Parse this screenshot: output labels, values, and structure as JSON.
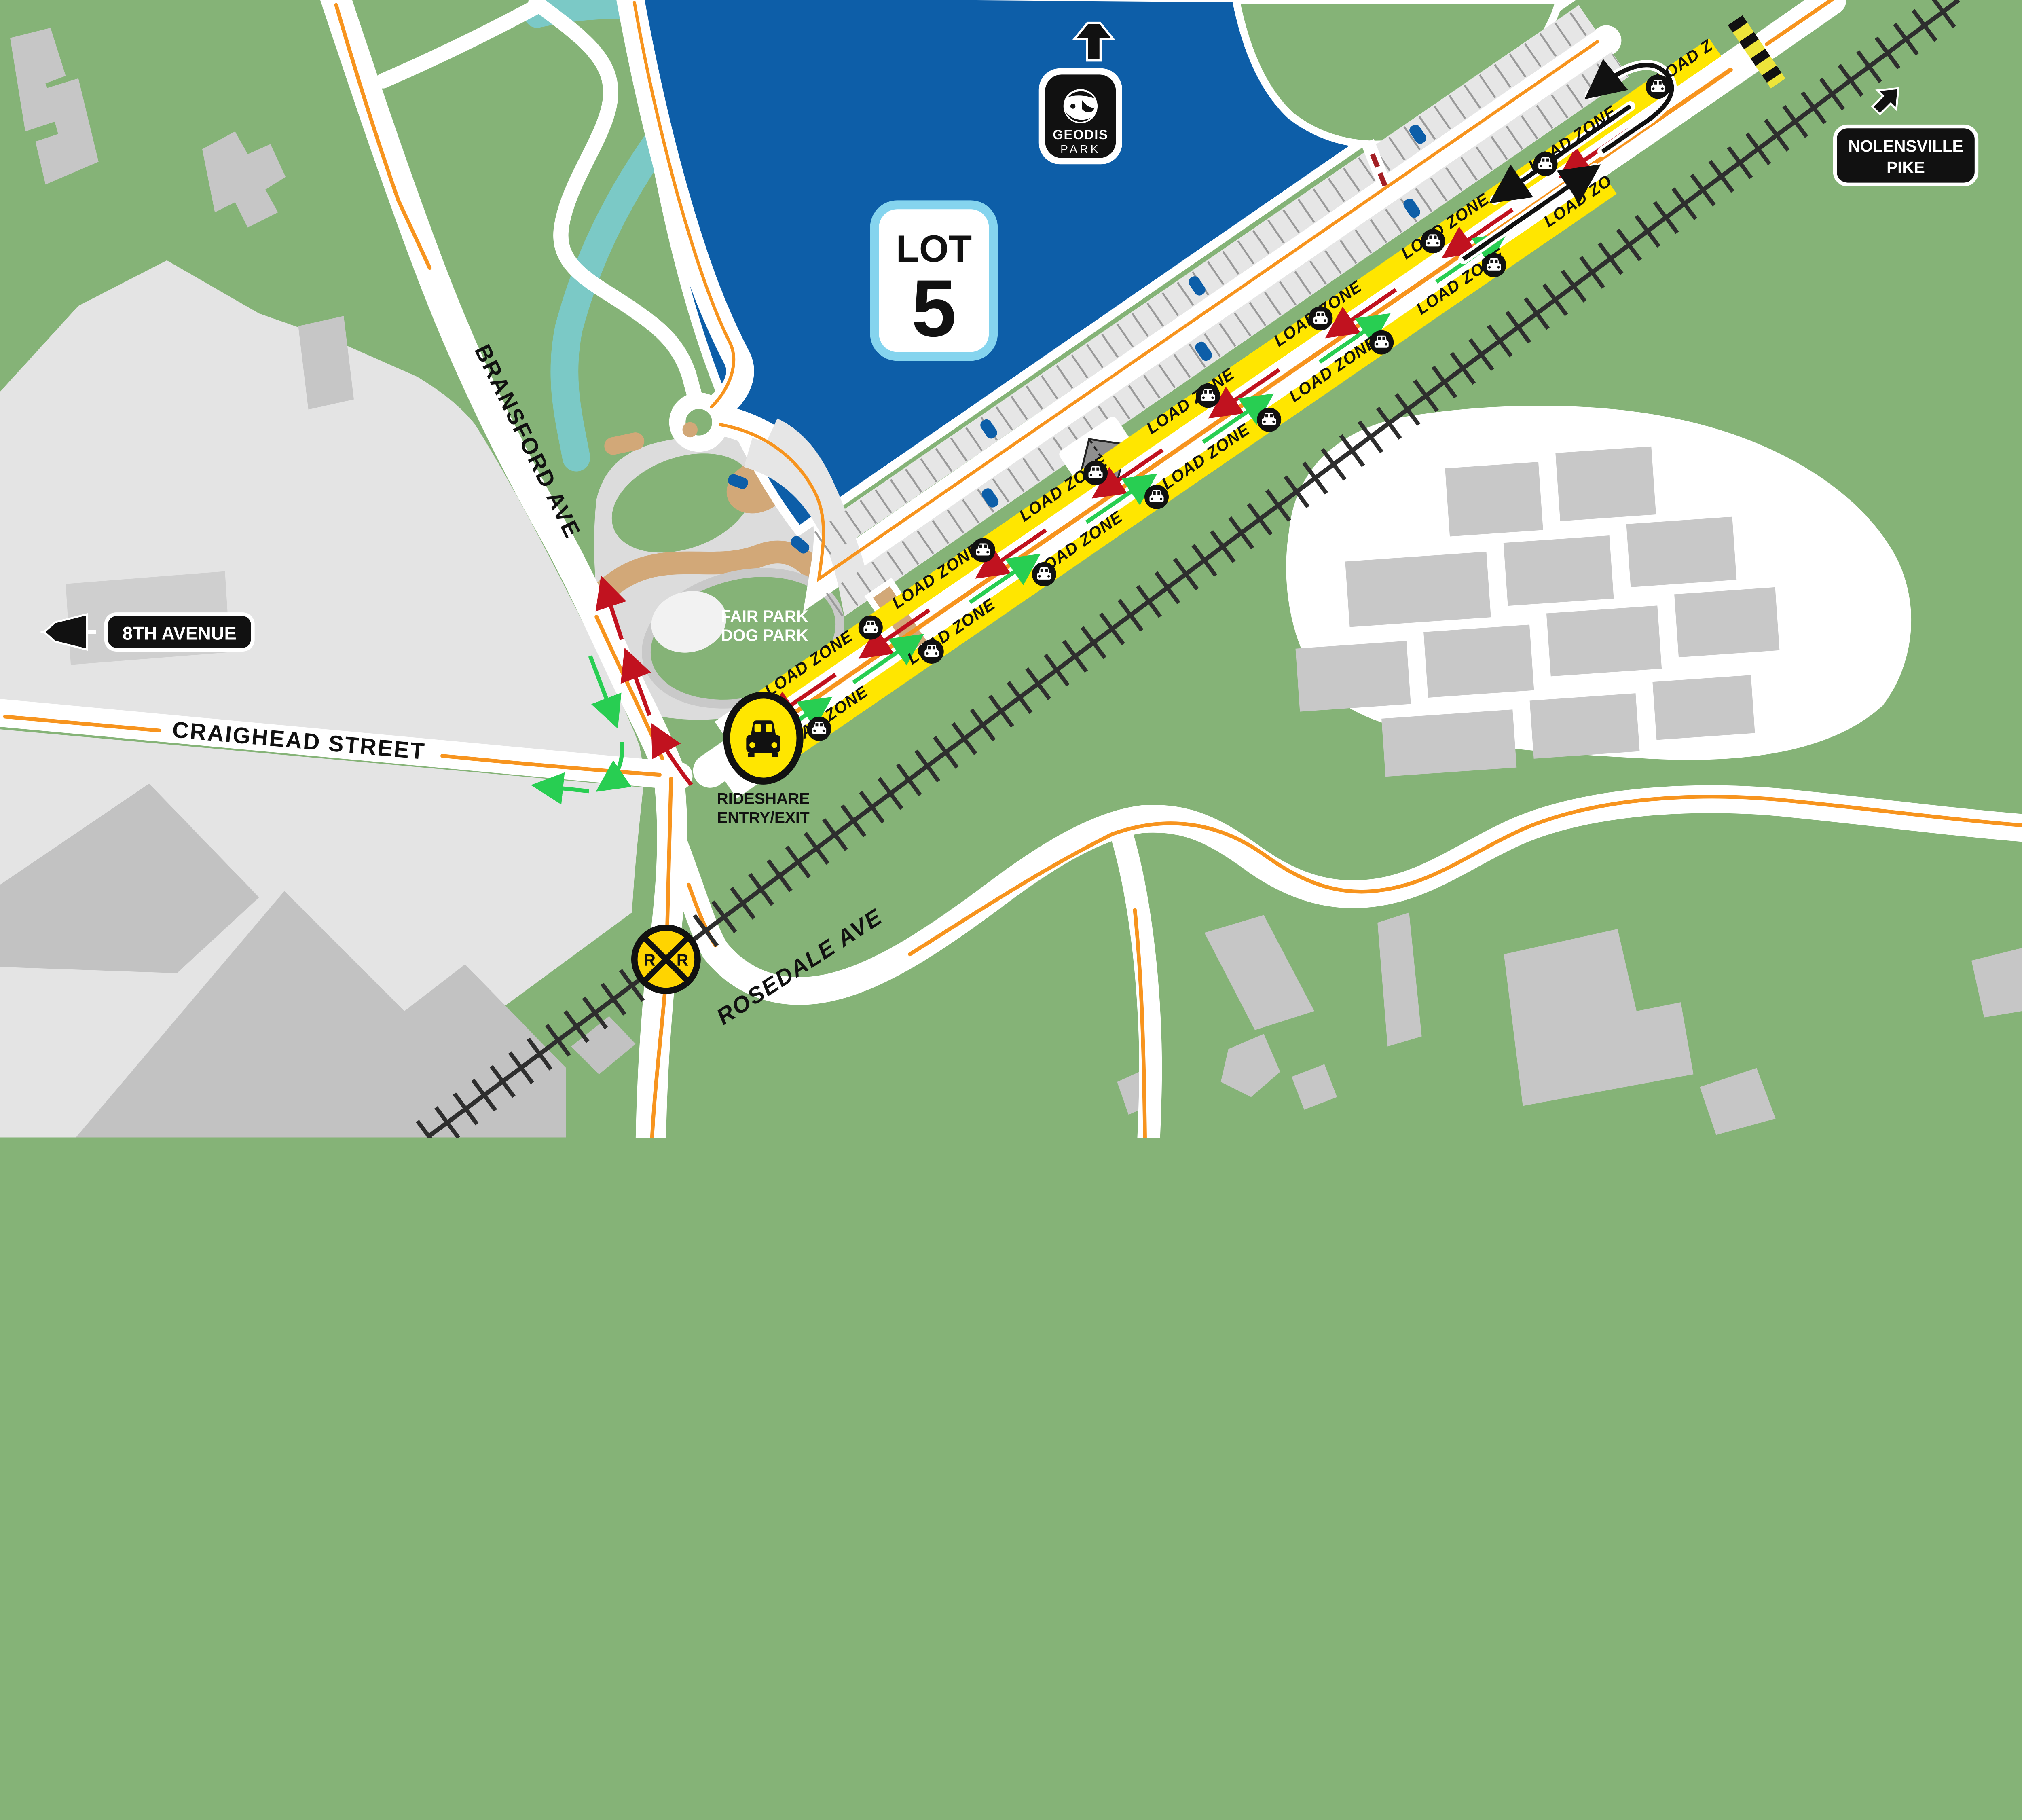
{
  "badges": {
    "lot": {
      "label": "LOT",
      "number": "5"
    },
    "venue": {
      "line1": "GEODIS",
      "line2": "PARK"
    }
  },
  "signs": {
    "eighth_avenue": "8TH AVENUE",
    "nolensville": {
      "line1": "NOLENSVILLE",
      "line2": "PIKE"
    }
  },
  "streets": {
    "bransford": "BRANSFORD AVE",
    "craighead": "CRAIGHEAD STREET",
    "rosedale": "ROSEDALE AVE"
  },
  "labels": {
    "dog_park": {
      "line1": "FAIR PARK",
      "line2": "DOG PARK"
    },
    "rideshare": {
      "line1": "RIDESHARE",
      "line2": "ENTRY/EXIT"
    }
  },
  "load_zone": {
    "label": "LOAD ZONE"
  },
  "railroad_sign": {
    "left": "R",
    "right": "R"
  },
  "colors": {
    "map_green": "#85B377",
    "lot_blue": "#0D5EA8",
    "lot_badge_border": "#85D4EE",
    "paved_gray": "#E4E4E4",
    "building_gray": "#C2C2C2",
    "road_white": "#FFFFFF",
    "center_line_orange": "#F7941E",
    "load_zone_yellow": "#FFE600",
    "exit_arrow_red": "#C1121F",
    "entry_arrow_green": "#28CE52",
    "creek_teal": "#7BC9C6",
    "rr_sign_yellow": "#FFD400",
    "tan_gravel": "#D2A878"
  },
  "icons": {
    "up-arrow-icon": "north arrow to stadium",
    "left-arrow-icon": "west arrow to 8th Avenue",
    "ne-arrow-icon": "northeast arrow to Nolensville Pike",
    "car-icon": "load zone car marker",
    "rideshare-car-icon": "rideshare entry/exit point",
    "railroad-crossing-icon": "RR crossbuck",
    "u-turn-arrow-icon": "turnaround",
    "barrier-icon": "road closed hazard stripe"
  }
}
